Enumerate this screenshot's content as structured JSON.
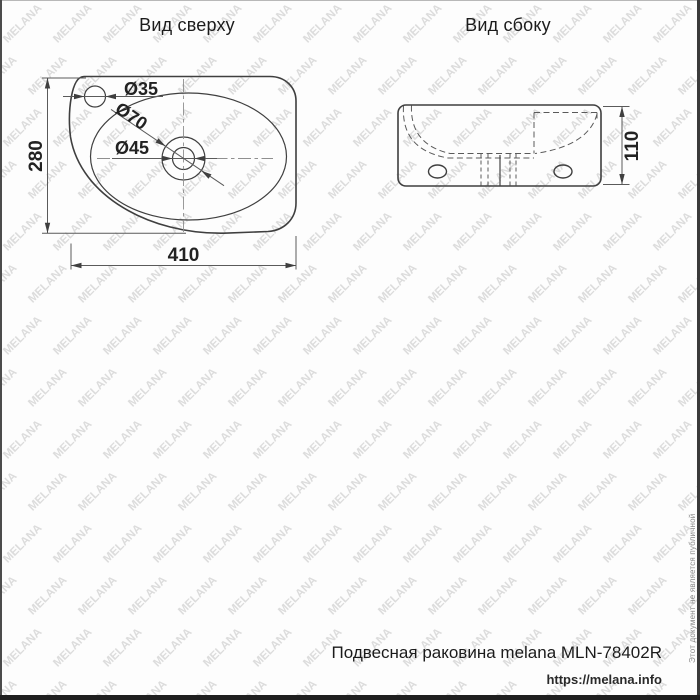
{
  "watermark": {
    "text": "MELANA"
  },
  "views": {
    "top": {
      "title": "Вид сверху",
      "dimensions": {
        "depth": "280",
        "width": "410",
        "tap_hole": "Ø35",
        "drain_outer": "Ø70",
        "drain_inner": "Ø45"
      }
    },
    "side": {
      "title": "Вид сбоку",
      "dimensions": {
        "height": "110"
      }
    }
  },
  "footer": {
    "product_label": "Подвесная раковина melana MLN-78402R",
    "website": "https://melana.info",
    "disclaimer": "Этот документ не является публичной офертой"
  },
  "colors": {
    "outline": "#3f3f3f",
    "dimension_lines": "#5a5a5a",
    "watermark": "#dcdcdc",
    "bottom_bar": "#1f1f1f"
  }
}
